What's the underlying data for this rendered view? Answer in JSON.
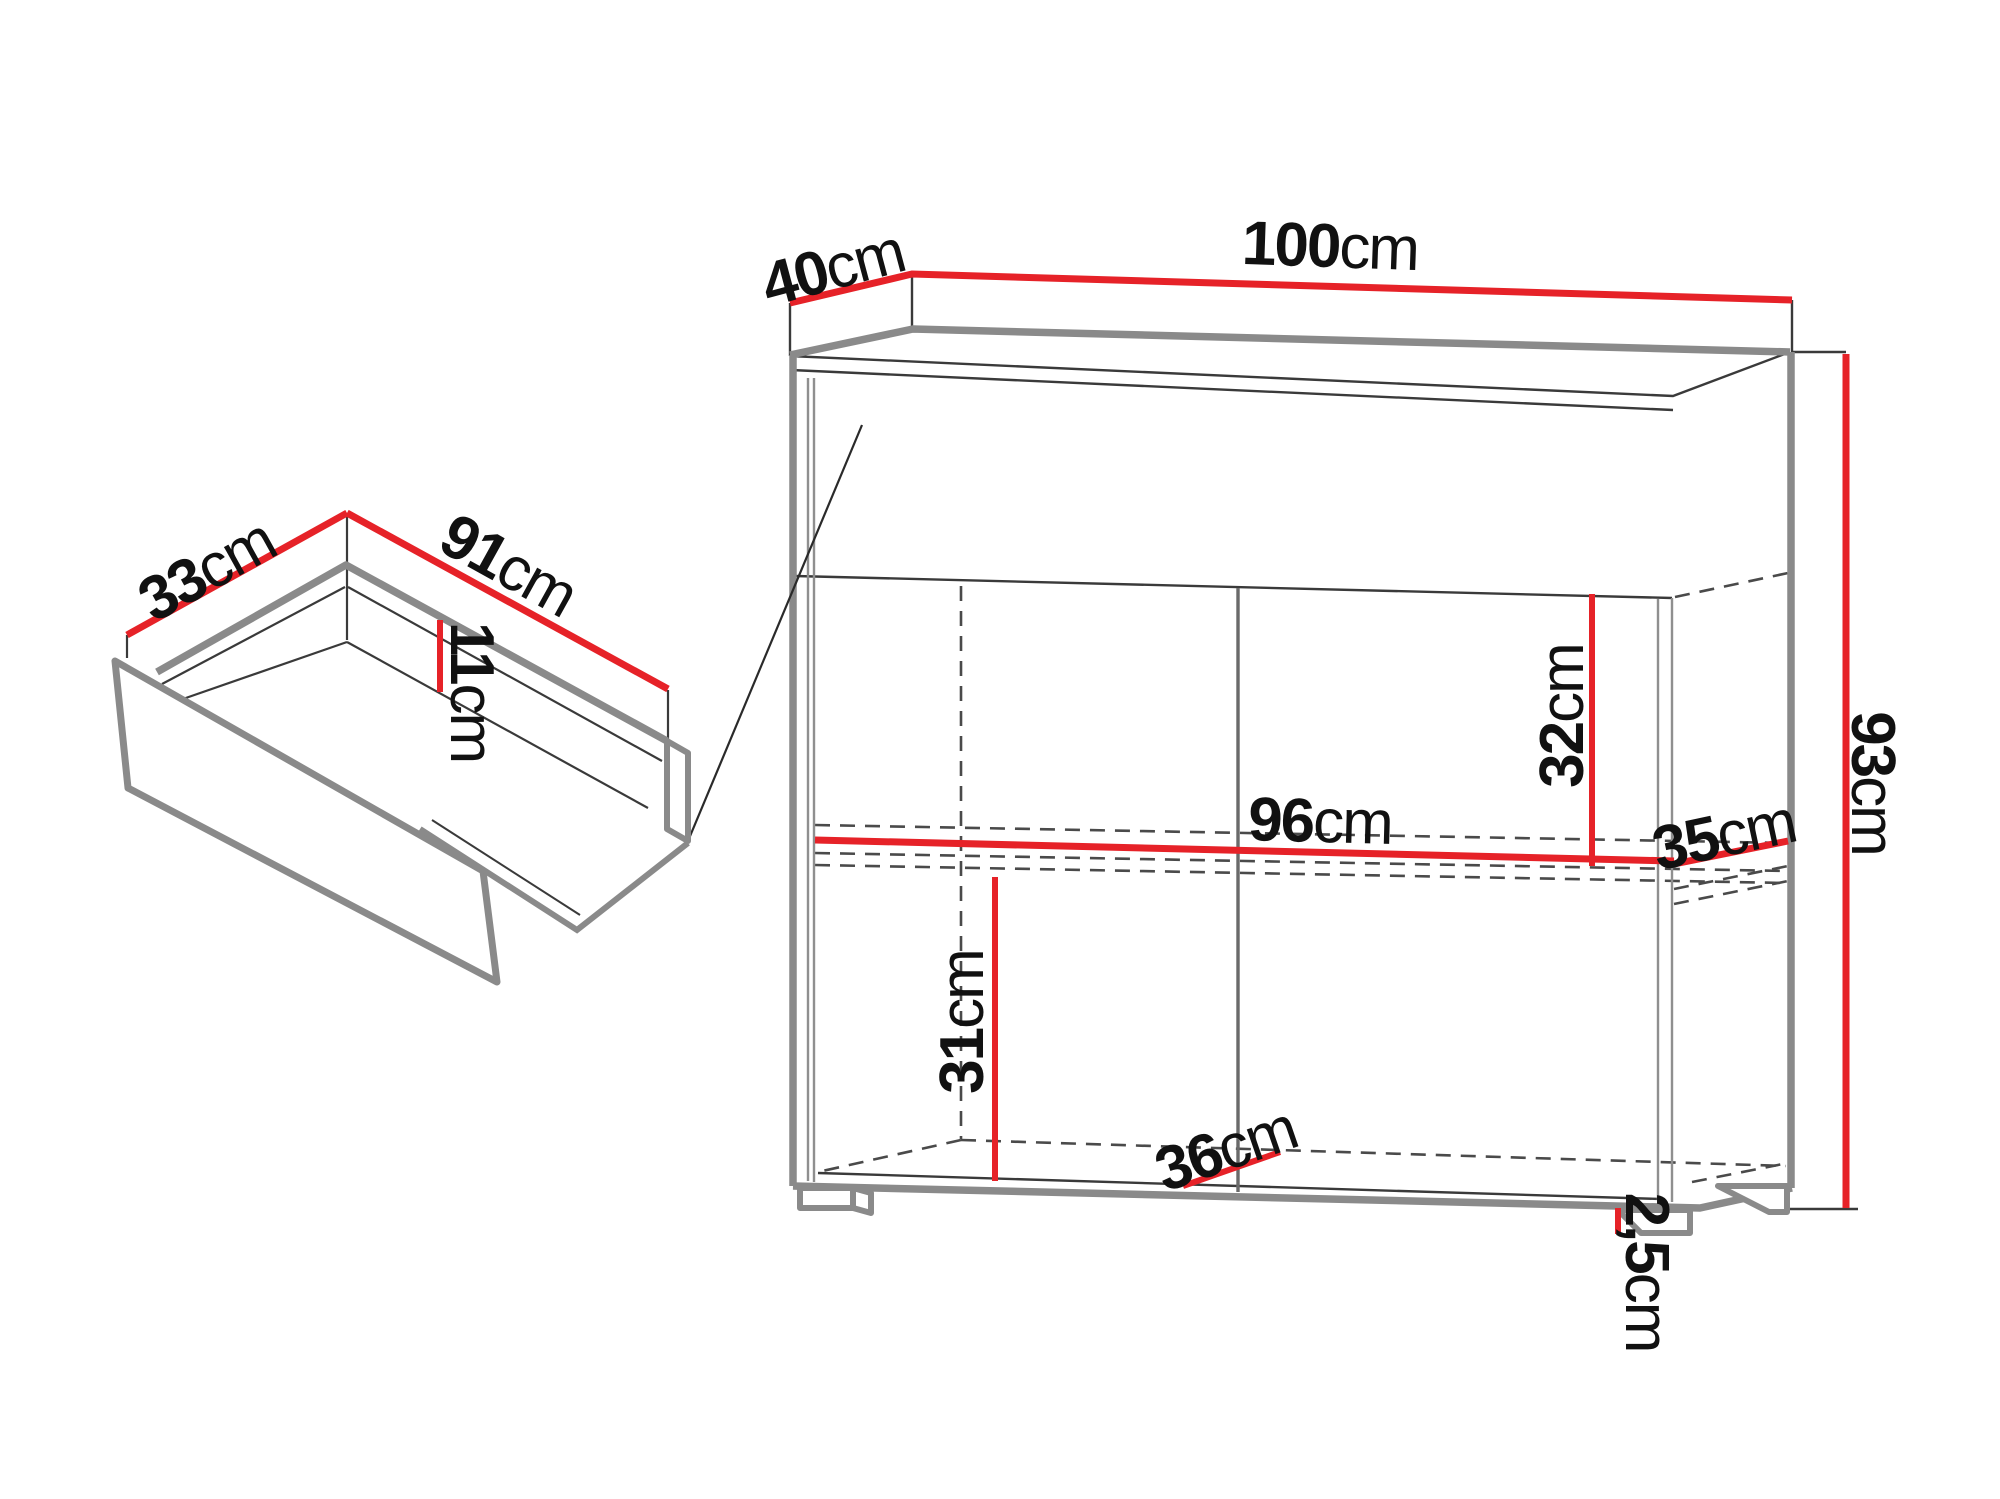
{
  "figure": {
    "type": "furniture-dimension-diagram",
    "views": [
      "drawer-isometric",
      "cabinet-front-perspective"
    ]
  },
  "colors": {
    "dimension_red": "#e62228",
    "structure_gray": "#8a8a8a",
    "line_black": "#333333",
    "background": "#ffffff"
  },
  "dimensions": {
    "cabinet_width": {
      "num": "100",
      "unit": "cm"
    },
    "cabinet_depth": {
      "num": "40",
      "unit": "cm"
    },
    "cabinet_height": {
      "num": "93",
      "unit": "cm"
    },
    "interior_width": {
      "num": "96",
      "unit": "cm"
    },
    "shelf_depth": {
      "num": "35",
      "unit": "cm"
    },
    "upper_section_height": {
      "num": "32",
      "unit": "cm"
    },
    "lower_section_height": {
      "num": "31",
      "unit": "cm"
    },
    "lower_compartment_width": {
      "num": "36",
      "unit": "cm"
    },
    "foot_height": {
      "num": "2,5",
      "unit": "cm"
    },
    "drawer_depth": {
      "num": "33",
      "unit": "cm"
    },
    "drawer_width": {
      "num": "91",
      "unit": "cm"
    },
    "drawer_inner_height": {
      "num": "11",
      "unit": "cm"
    }
  }
}
